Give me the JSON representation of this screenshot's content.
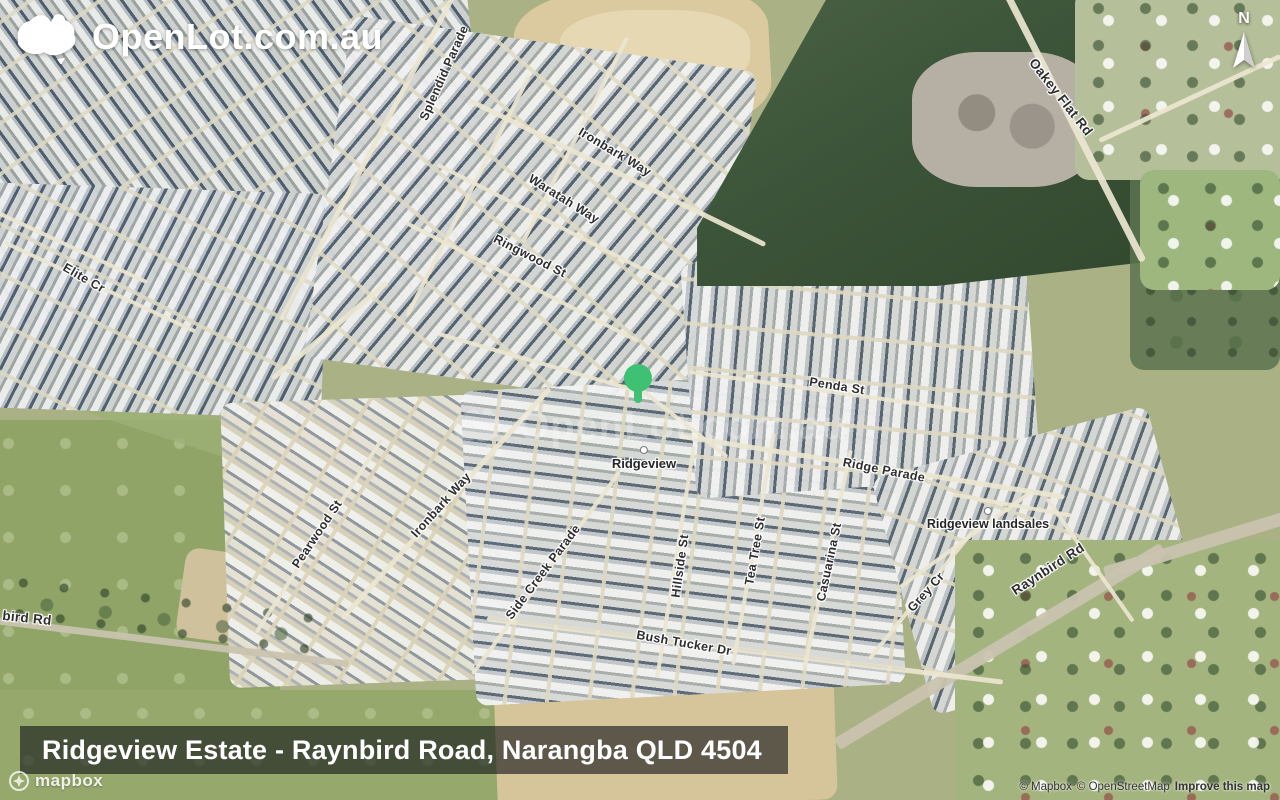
{
  "logo": {
    "text": "OpenLot.com.au"
  },
  "watermark": {
    "text": "OpenLot.com.au"
  },
  "compass": {
    "label": "N"
  },
  "title_bar": {
    "text": "Ridgeview Estate - Raynbird Road, Narangba QLD 4504"
  },
  "attribution": {
    "mapbox": "© Mapbox",
    "openstreetmap": "© OpenStreetMap",
    "improve": "Improve this map",
    "mapbox_wordmark": "mapbox"
  },
  "colors": {
    "marker_green": "#3ec173",
    "title_bar_background": "rgba(13,16,22,0.60)"
  },
  "map": {
    "type": "satellite",
    "marker": {
      "color": "#3ec173"
    },
    "place_labels": [
      {
        "name": "Ridgeview"
      },
      {
        "name": "Ridgeview landsales"
      }
    ],
    "street_labels": [
      {
        "name": "Splendid Parade"
      },
      {
        "name": "Ironbark Way"
      },
      {
        "name": "Waratah Way"
      },
      {
        "name": "Ringwood St"
      },
      {
        "name": "Elite Cr"
      },
      {
        "name": "Oakey Flat Rd"
      },
      {
        "name": "Penda St"
      },
      {
        "name": "Ridge Parade"
      },
      {
        "name": "Raynbird Rd"
      },
      {
        "name": "Grey Cr"
      },
      {
        "name": "Side Creek Parade"
      },
      {
        "name": "Hillside St"
      },
      {
        "name": "Tea Tree St"
      },
      {
        "name": "Casuarina St"
      },
      {
        "name": "Bush Tucker Dr"
      },
      {
        "name": "Pearwood St"
      },
      {
        "name": "Ironbark Way"
      },
      {
        "name": "bird Rd"
      }
    ]
  }
}
